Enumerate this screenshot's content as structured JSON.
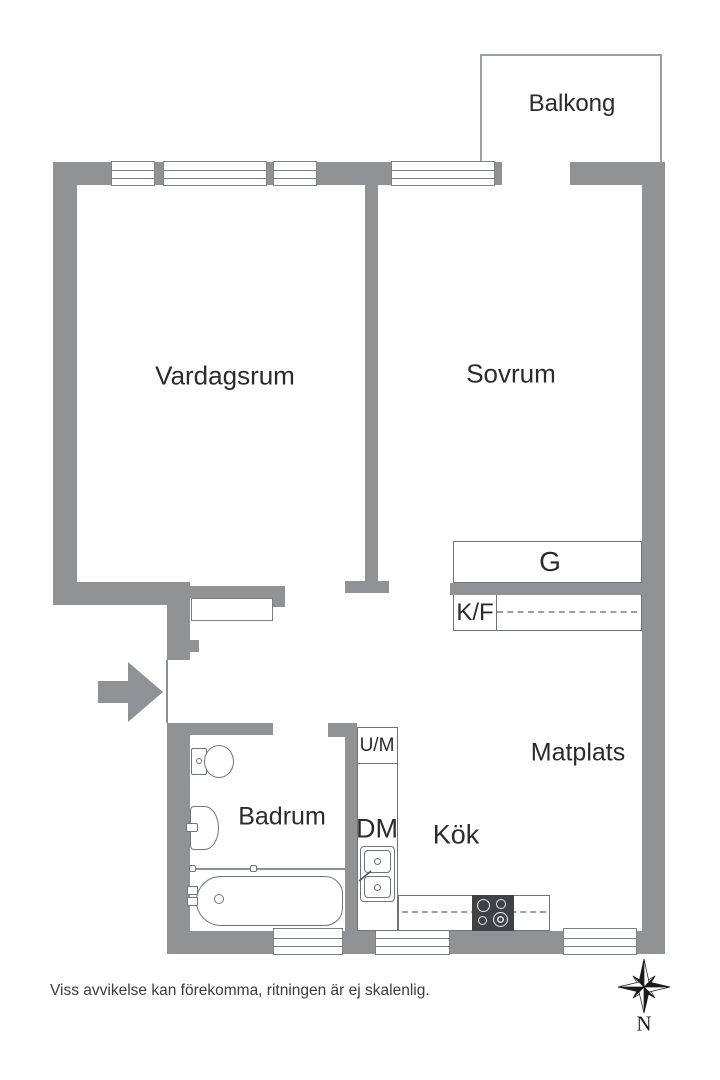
{
  "plan_title": "Apartment floor plan",
  "colors": {
    "wall": "#8f9396",
    "outline": "#70757a",
    "stove": "#3f4245",
    "text": "#2b2b2b"
  },
  "rooms": {
    "balkong": "Balkong",
    "vardagsrum": "Vardagsrum",
    "sovrum": "Sovrum",
    "matplats": "Matplats",
    "kok": "Kök",
    "badrum": "Badrum"
  },
  "fixtures": {
    "garderob": "G",
    "kyl_frys": "K/F",
    "tvattmaskin": "U/M",
    "diskmaskin": "DM"
  },
  "footer": {
    "disclaimer": "Viss avvikelse kan förekomma, ritningen är ej skalenlig."
  },
  "compass": {
    "north": "N"
  }
}
